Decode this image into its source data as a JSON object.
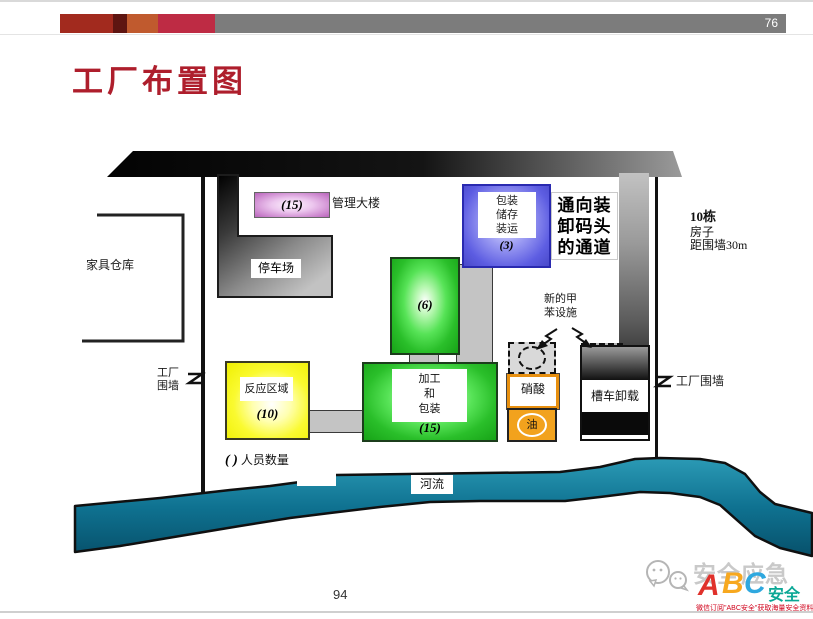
{
  "header": {
    "page_number": "76",
    "title": "工厂布置图",
    "accent_colors": [
      "#A22A1E",
      "#5E1511",
      "#C05A2E",
      "#BE2B44"
    ],
    "bar_color": "#7C7C7C"
  },
  "diagram": {
    "furniture_warehouse": {
      "label": "家具仓库"
    },
    "management": {
      "count": "(15)",
      "label": "管理大楼"
    },
    "parking": {
      "label": "停车场"
    },
    "packing_shipping": {
      "line1": "包装",
      "line2": "储存",
      "line3": "装运",
      "count": "(3)"
    },
    "dock_passage": {
      "line1": "通向装",
      "line2": "卸码头",
      "line3": "的通道"
    },
    "houses_note": {
      "line1": "10栋",
      "line2": "房子",
      "line3": "距围墙30m"
    },
    "unit6": {
      "count": "(6)"
    },
    "toluene": {
      "line1": "新的甲",
      "line2": "苯设施"
    },
    "reaction": {
      "label": "反应区域",
      "count": "(10)"
    },
    "processing": {
      "line1": "加工",
      "line2": "和",
      "line3": "包装",
      "count": "(15)"
    },
    "nitric_acid": {
      "label": "硝酸"
    },
    "oil": {
      "label": "油"
    },
    "tanker": {
      "label": "槽车卸载"
    },
    "wall_left": {
      "line1": "工厂",
      "line2": "围墙"
    },
    "wall_right": {
      "label": "工厂围墙"
    },
    "legend": {
      "paren": "( )",
      "label": "人员数量"
    },
    "river": {
      "label": "河流"
    },
    "colors": {
      "management_fill": "#C99BCC",
      "packing_fill": "#5A5ADF",
      "unit_green": "#2FCC2F",
      "reaction_yellow": "#F6F600",
      "acid_border_orange": "#E89010",
      "oil_orange": "#F2A21D",
      "river_teal": "#17809F",
      "road_black": "#0A0A0A",
      "road_gray": "#8A8A8A"
    }
  },
  "footer": {
    "page_number": "94",
    "logo": {
      "brand": "安全应急",
      "abc": {
        "a": "A",
        "b": "B",
        "c": "C"
      },
      "suffix": "安全",
      "caption": "微信订阅\"ABC安全\"获取海量安全资料"
    }
  }
}
